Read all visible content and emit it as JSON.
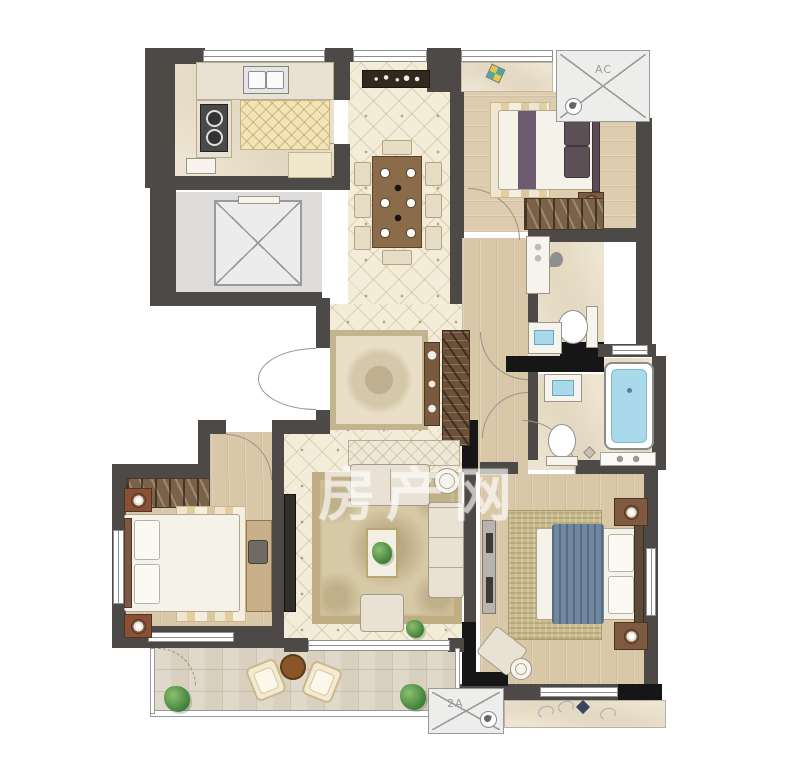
{
  "title": "apartment-floor-plan",
  "watermark": {
    "text": "房产网"
  },
  "labels": {
    "ac_top": "AC",
    "ac_bottom": "2A"
  },
  "colors": {
    "wall": "#4d4946",
    "wall_black": "#161616",
    "tile_floor": "#f3ecd9",
    "wood_floor": "#d9c8a8",
    "marble_floor": "#ede4d1",
    "water_blue": "#a9d9ea",
    "rug_olive": "#c9bc8c",
    "bed_throw_blue": "#7288a0",
    "ac_platform": "#ededeb",
    "wardrobe_wood": "#7a6248",
    "dining_table_wood": "#8a6b4a"
  },
  "icons": {
    "fan": "ac-fan-swirl",
    "elevator": "crossed-diagonals-box",
    "plant": "green-shrub",
    "drain": "rotated-diamond"
  },
  "rooms": [
    "kitchen",
    "elevator-lobby",
    "dining-room",
    "bedroom-top-right",
    "shared-bathroom",
    "master-bathroom",
    "foyer",
    "hallway",
    "living-room",
    "bedroom-bottom-left",
    "master-bedroom",
    "balcony",
    "flower-bed"
  ]
}
